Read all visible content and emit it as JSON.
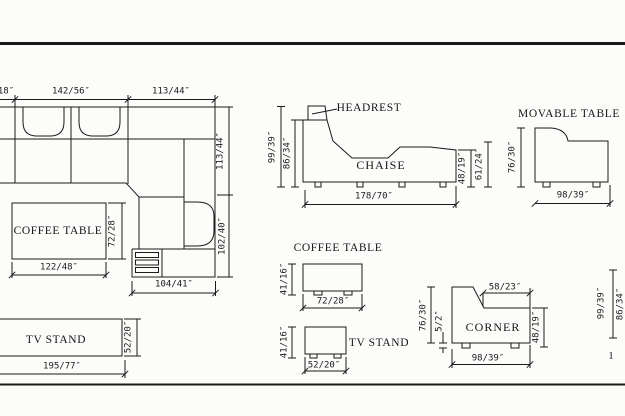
{
  "colors": {
    "background": "#fcfcfb",
    "line": "#1a1a1a"
  },
  "drawing": {
    "page_number": "1",
    "sectional_plan": {
      "dim_left_partial": "18″",
      "dim_top_left_section": "142/56″",
      "dim_top_right_section": "113/44″",
      "dim_right_upper": "113/44″",
      "dim_right_lower": "102/40″",
      "dim_chaise_width": "104/41″"
    },
    "coffee_table_plan": {
      "label": "COFFEE TABLE",
      "dim_width": "122/48″",
      "dim_depth": "72/28″"
    },
    "tv_stand_plan": {
      "label": "TV STAND",
      "dim_width": "195/77″",
      "dim_depth": "52/20″"
    },
    "chaise_elevation": {
      "label": "CHAISE",
      "callout": "HEADREST",
      "dim_height_total": "99/39″",
      "dim_height_body": "86/34″",
      "dim_length": "178/70″",
      "dim_arm_height": "48/19″",
      "dim_back_height": "61/24″"
    },
    "movable_table_elevation": {
      "label": "MOVABLE TABLE",
      "dim_height": "76/30″",
      "dim_width": "98/39″"
    },
    "coffee_table_elevation": {
      "label": "COFFEE TABLE",
      "dim_height": "41/16″",
      "dim_width": "72/28″"
    },
    "tv_stand_elevation": {
      "label": "TV STAND",
      "dim_height": "41/16″",
      "dim_width": "52/20″"
    },
    "corner_elevation": {
      "label": "CORNER",
      "dim_top": "58/23″",
      "dim_height": "76/30″",
      "dim_feet": "5/2″",
      "dim_arm_height": "48/19″",
      "dim_width": "98/39″",
      "dim_far_right_outer": "99/39″",
      "dim_far_right_inner": "86/34″"
    }
  }
}
